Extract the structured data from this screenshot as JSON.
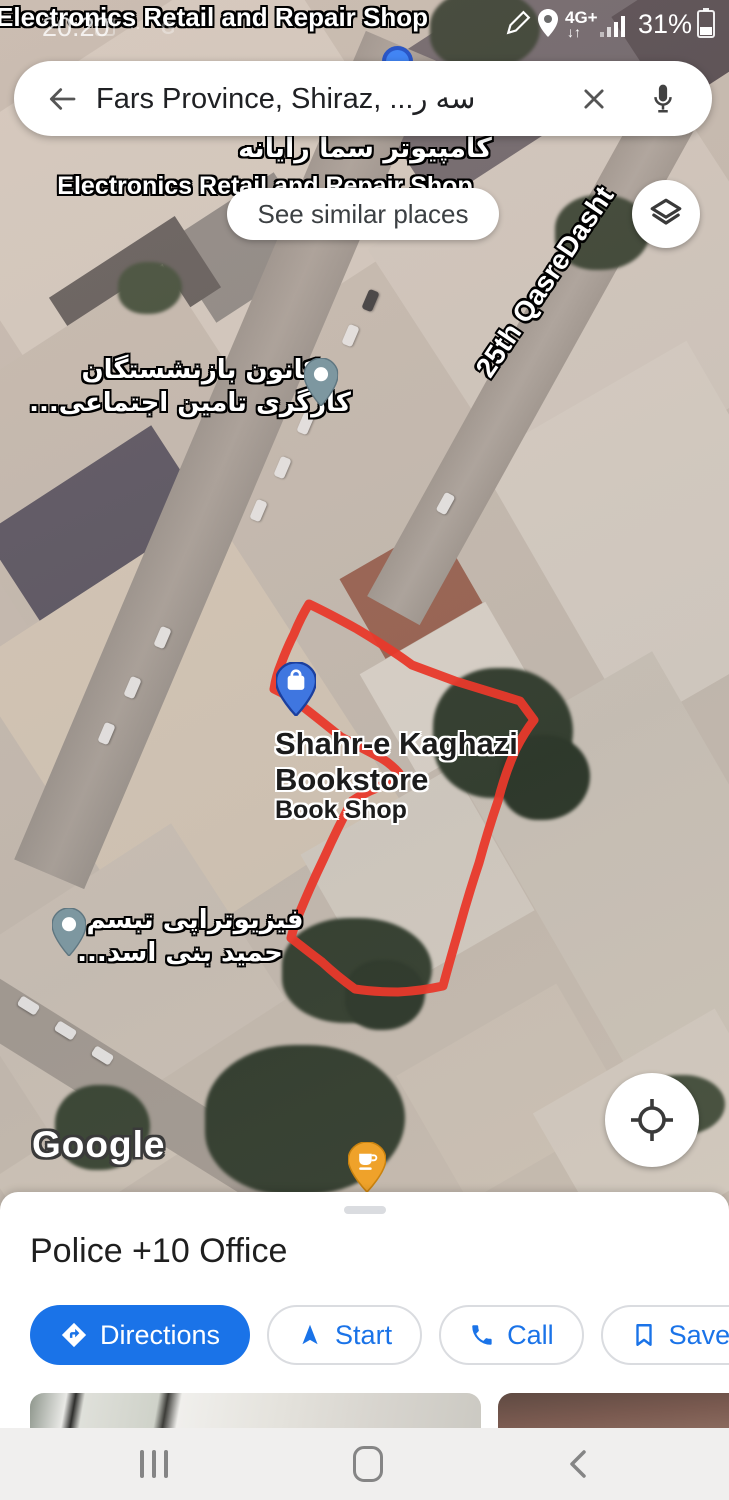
{
  "status_bar": {
    "time": "20:20",
    "network": "4G+",
    "battery": "31%"
  },
  "search": {
    "query": "Fars Province, Shiraz, ...سه ر"
  },
  "map": {
    "see_similar": "See similar places",
    "labels": {
      "top_place": "Electronics Retail and Repair Shop",
      "computer_store_fa": "کامپیوتر سما رایانه",
      "computer_store_en": "Electronics Retail and Repair Shop",
      "street": "25th QasreDasht",
      "retiree_center_line1": "کانون بازنشستگان",
      "retiree_center_line2": "کارگری تامین اجتماعی...",
      "bookstore_line1": "Shahr-e Kaghazi",
      "bookstore_line2": "Bookstore",
      "bookstore_type": "Book Shop",
      "physio_line1": "فیزیوتراپی تبسم",
      "physio_line2": "حمید بنی اسد...",
      "logo": "Google"
    }
  },
  "sheet": {
    "title": "Police +10 Office",
    "actions": {
      "directions": "Directions",
      "start": "Start",
      "call": "Call",
      "save": "Save"
    }
  },
  "colors": {
    "accent_blue": "#1a73e8",
    "region_red": "#e8392b",
    "pin_teal": "#7d97a0",
    "pin_orange": "#efa22a",
    "pin_blue": "#3f76e0"
  }
}
